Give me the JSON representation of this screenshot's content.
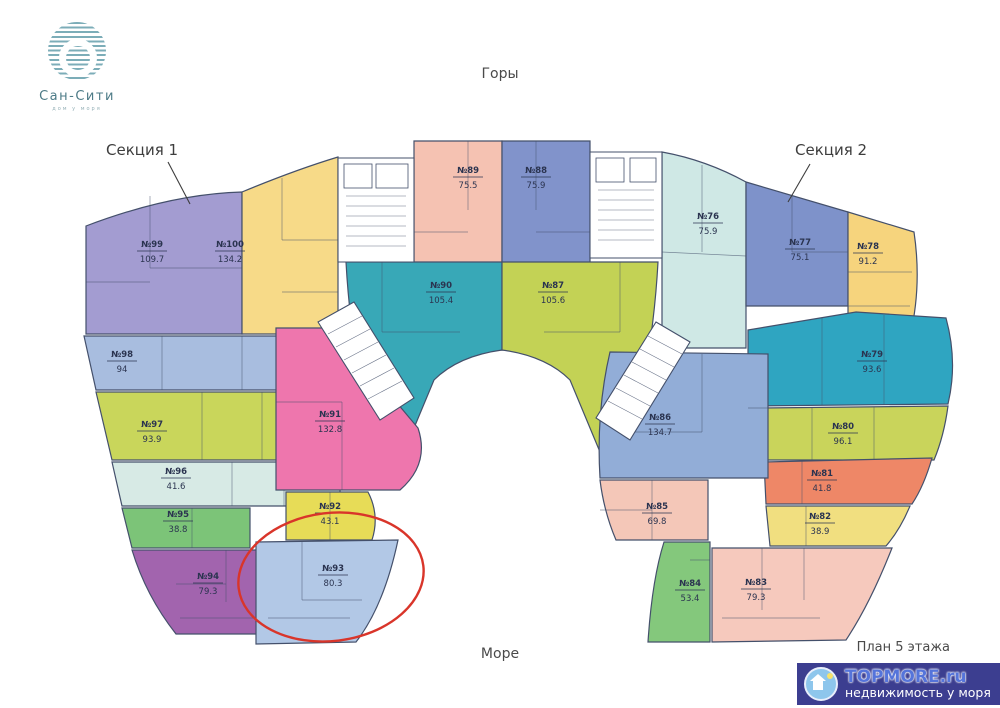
{
  "brand": {
    "name": "Сан-Сити",
    "tagline": "дом у моря",
    "logo_color": "#7cadb8"
  },
  "labels": {
    "top_direction": "Горы",
    "bottom_direction": "Море",
    "section1": "Секция 1",
    "section2": "Секция 2",
    "plan_caption": "План 5 этажа"
  },
  "watermark": {
    "title": "TOPMORE.ru",
    "subtitle": "недвижимость у моря",
    "bg": "#3c3e90"
  },
  "highlight": {
    "target": "№93",
    "color": "#d9352a",
    "cx": 331,
    "cy": 577,
    "rx": 93,
    "ry": 64,
    "rotate": -7
  },
  "plan": {
    "stroke": "#44506b",
    "leaders": [
      [
        168,
        162,
        190,
        204
      ],
      [
        810,
        164,
        788,
        202
      ]
    ],
    "apartments": [
      {
        "id": "99",
        "number": "№99",
        "area": "109.7",
        "color": "#a39cd1",
        "label": [
          152,
          250
        ],
        "path": "M86,226 Q170,194 242,192 L242,334 L86,334 Z",
        "partitions": [
          [
            150,
            196,
            150,
            268
          ],
          [
            150,
            268,
            242,
            268
          ],
          [
            86,
            282,
            150,
            282
          ]
        ]
      },
      {
        "id": "100",
        "number": "№100",
        "area": "134.2",
        "color": "#f7da88",
        "label": [
          230,
          250
        ],
        "path": "M242,192 Q295,170 338,157 L338,334 L242,334 Z",
        "partitions": [
          [
            282,
            178,
            282,
            240
          ],
          [
            282,
            240,
            338,
            240
          ],
          [
            282,
            292,
            338,
            292
          ]
        ]
      },
      {
        "id": "89",
        "number": "№89",
        "area": "75.5",
        "color": "#f5c2b2",
        "label": [
          468,
          176
        ],
        "path": "M414,141 L502,141 L502,350 L414,350 Z",
        "partitions": [
          [
            414,
            232,
            468,
            232
          ],
          [
            468,
            141,
            468,
            210
          ],
          [
            438,
            292,
            502,
            292
          ]
        ]
      },
      {
        "id": "88",
        "number": "№88",
        "area": "75.9",
        "color": "#8193cb",
        "label": [
          536,
          176
        ],
        "path": "M502,141 L590,141 L590,350 L502,350 Z",
        "partitions": [
          [
            536,
            141,
            536,
            210
          ],
          [
            536,
            232,
            590,
            232
          ],
          [
            502,
            292,
            566,
            292
          ]
        ]
      },
      {
        "id": "90",
        "number": "№90",
        "area": "105.4",
        "color": "#38a8b7",
        "label": [
          441,
          291
        ],
        "path": "M346,262 L502,262 L502,350 Q458,356 434,380 L404,452 L366,408 Q350,336 346,262 Z",
        "partitions": [
          [
            382,
            262,
            382,
            332
          ],
          [
            382,
            332,
            460,
            332
          ]
        ]
      },
      {
        "id": "87",
        "number": "№87",
        "area": "105.6",
        "color": "#c3d255",
        "label": [
          553,
          291
        ],
        "path": "M502,262 L658,262 Q654,336 638,408 L600,452 L570,380 Q546,356 502,350 Z",
        "partitions": [
          [
            620,
            262,
            620,
            332
          ],
          [
            544,
            332,
            620,
            332
          ]
        ]
      },
      {
        "id": "98",
        "number": "№98",
        "area": "94",
        "color": "#a8bddf",
        "label": [
          122,
          360
        ],
        "path": "M84,336 L336,336 L336,390 L96,390 Z",
        "partitions": [
          [
            162,
            336,
            162,
            390
          ],
          [
            242,
            336,
            242,
            390
          ],
          [
            284,
            336,
            284,
            390
          ]
        ]
      },
      {
        "id": "97",
        "number": "№97",
        "area": "93.9",
        "color": "#c9d65b",
        "label": [
          152,
          430
        ],
        "path": "M96,392 L336,392 L336,460 L112,460 Z",
        "partitions": [
          [
            202,
            392,
            202,
            460
          ],
          [
            262,
            392,
            262,
            460
          ]
        ]
      },
      {
        "id": "96",
        "number": "№96",
        "area": "41.6",
        "color": "#d7eae5",
        "label": [
          176,
          477
        ],
        "path": "M112,462 L340,462 L340,506 L122,506 Z",
        "partitions": [
          [
            232,
            462,
            232,
            506
          ],
          [
            284,
            462,
            284,
            506
          ]
        ]
      },
      {
        "id": "95",
        "number": "№95",
        "area": "38.8",
        "color": "#7cc478",
        "label": [
          178,
          520
        ],
        "path": "M122,508 L250,508 L250,548 L132,548 Z",
        "partitions": [
          [
            192,
            508,
            192,
            548
          ]
        ]
      },
      {
        "id": "94",
        "number": "№94",
        "area": "79.3",
        "color": "#a264ae",
        "label": [
          208,
          582
        ],
        "path": "M132,550 L272,550 L272,634 L176,634 Q146,596 132,550 Z",
        "partitions": [
          [
            226,
            550,
            226,
            602
          ],
          [
            176,
            584,
            226,
            584
          ],
          [
            180,
            618,
            268,
            618
          ]
        ]
      },
      {
        "id": "91",
        "number": "№91",
        "area": "132.8",
        "color": "#ee76ad",
        "label": [
          330,
          420
        ],
        "path": "M276,328 L334,328 L418,428 Q430,464 400,490 L276,490 Z",
        "partitions": [
          [
            276,
            402,
            342,
            402
          ],
          [
            342,
            402,
            342,
            490
          ]
        ]
      },
      {
        "id": "92",
        "number": "№92",
        "area": "43.1",
        "color": "#e7dc57",
        "label": [
          330,
          512
        ],
        "path": "M286,492 L368,492 Q380,515 372,540 L286,540 Z",
        "partitions": [
          [
            330,
            492,
            330,
            540
          ]
        ]
      },
      {
        "id": "93",
        "number": "№93",
        "area": "80.3",
        "color": "#b2c8e6",
        "label": [
          333,
          574
        ],
        "path": "M256,542 L398,540 Q384,606 356,642 L256,644 Z",
        "partitions": [
          [
            302,
            542,
            302,
            600
          ],
          [
            302,
            600,
            362,
            600
          ],
          [
            268,
            618,
            350,
            618
          ]
        ]
      },
      {
        "id": "76",
        "number": "№76",
        "area": "75.9",
        "color": "#cfe8e5",
        "label": [
          708,
          222
        ],
        "path": "M662,152 Q706,160 746,182 L746,348 L662,348 Z",
        "partitions": [
          [
            702,
            165,
            702,
            252
          ],
          [
            662,
            252,
            746,
            256
          ]
        ]
      },
      {
        "id": "77",
        "number": "№77",
        "area": "75.1",
        "color": "#7e92ca",
        "label": [
          800,
          248
        ],
        "path": "M746,182 L848,212 L848,306 L746,306 Z",
        "partitions": [
          [
            792,
            196,
            792,
            252
          ],
          [
            792,
            252,
            848,
            252
          ]
        ]
      },
      {
        "id": "78",
        "number": "№78",
        "area": "91.2",
        "color": "#f6d47d",
        "label": [
          868,
          252
        ],
        "path": "M848,212 L914,232 Q922,286 910,336 L848,336 Z",
        "partitions": [
          [
            848,
            272,
            912,
            272
          ],
          [
            848,
            306,
            910,
            306
          ]
        ]
      },
      {
        "id": "79",
        "number": "№79",
        "area": "93.6",
        "color": "#2fa5c1",
        "label": [
          872,
          360
        ],
        "path": "M748,330 L856,312 L946,318 Q958,362 948,404 L748,406 Z",
        "partitions": [
          [
            822,
            318,
            822,
            405
          ],
          [
            884,
            315,
            884,
            404
          ]
        ]
      },
      {
        "id": "80",
        "number": "№80",
        "area": "96.1",
        "color": "#c9d45b",
        "label": [
          843,
          432
        ],
        "path": "M762,408 L948,406 Q944,436 934,460 L764,460 Z",
        "partitions": [
          [
            812,
            407,
            812,
            460
          ],
          [
            874,
            407,
            874,
            460
          ]
        ]
      },
      {
        "id": "81",
        "number": "№81",
        "area": "41.8",
        "color": "#ee8767",
        "label": [
          822,
          479
        ],
        "path": "M764,462 L932,458 Q924,486 912,504 L766,504 Z",
        "partitions": [
          [
            802,
            460,
            802,
            504
          ]
        ]
      },
      {
        "id": "82",
        "number": "№82",
        "area": "38.9",
        "color": "#f1df80",
        "label": [
          820,
          522
        ],
        "path": "M766,506 L910,506 Q900,530 886,546 L770,546 Z",
        "partitions": [
          [
            806,
            506,
            806,
            546
          ]
        ]
      },
      {
        "id": "83",
        "number": "№83",
        "area": "79.3",
        "color": "#f6c9bd",
        "label": [
          756,
          588
        ],
        "path": "M712,548 L892,548 Q870,604 846,640 L712,642 Z",
        "partitions": [
          [
            762,
            548,
            762,
            610
          ],
          [
            804,
            548,
            804,
            600
          ],
          [
            722,
            618,
            820,
            618
          ]
        ]
      },
      {
        "id": "84",
        "number": "№84",
        "area": "53.4",
        "color": "#84c87c",
        "label": [
          690,
          589
        ],
        "path": "M664,542 L710,542 L710,642 L648,642 Q652,580 664,542 Z",
        "partitions": [
          [
            690,
            560,
            710,
            560
          ]
        ]
      },
      {
        "id": "85",
        "number": "№85",
        "area": "69.8",
        "color": "#f4c7b8",
        "label": [
          657,
          512
        ],
        "path": "M600,480 L708,480 L708,540 L616,540 Q604,512 600,480 Z",
        "partitions": [
          [
            652,
            480,
            652,
            540
          ],
          [
            600,
            510,
            652,
            510
          ]
        ]
      },
      {
        "id": "86",
        "number": "№86",
        "area": "134.7",
        "color": "#92add7",
        "label": [
          660,
          423
        ],
        "path": "M610,352 L768,354 L768,478 L600,478 Q596,412 610,352 Z",
        "partitions": [
          [
            702,
            354,
            702,
            432
          ],
          [
            620,
            432,
            702,
            432
          ],
          [
            748,
            408,
            768,
            408
          ]
        ]
      }
    ],
    "cores": [
      {
        "id": "stair-core-left",
        "path": "M338,158 L414,158 L414,262 L338,262 Z",
        "lines": [
          [
            346,
            196,
            406,
            196
          ],
          [
            346,
            206,
            406,
            206
          ],
          [
            346,
            216,
            406,
            216
          ],
          [
            346,
            226,
            406,
            226
          ],
          [
            346,
            236,
            406,
            236
          ],
          [
            346,
            246,
            406,
            246
          ]
        ],
        "shafts": [
          [
            344,
            164,
            28,
            24
          ],
          [
            376,
            164,
            32,
            24
          ]
        ]
      },
      {
        "id": "stair-core-right",
        "path": "M590,152 L662,152 L662,258 L590,258 Z",
        "lines": [
          [
            598,
            190,
            654,
            190
          ],
          [
            598,
            200,
            654,
            200
          ],
          [
            598,
            210,
            654,
            210
          ],
          [
            598,
            220,
            654,
            220
          ],
          [
            598,
            230,
            654,
            230
          ],
          [
            598,
            240,
            654,
            240
          ]
        ],
        "shafts": [
          [
            596,
            158,
            28,
            24
          ],
          [
            630,
            158,
            26,
            24
          ]
        ]
      },
      {
        "id": "stair-core-left-diagonal",
        "path": "M318,322 L354,302 L414,398 L380,420 Z",
        "lines": [
          [
            328,
            334,
            362,
            316
          ],
          [
            336,
            347,
            370,
            329
          ],
          [
            344,
            360,
            378,
            342
          ],
          [
            352,
            373,
            386,
            355
          ],
          [
            360,
            386,
            394,
            368
          ],
          [
            368,
            399,
            402,
            381
          ]
        ],
        "shafts": []
      },
      {
        "id": "stair-core-right-diagonal",
        "path": "M656,322 L690,342 L630,440 L596,418 Z",
        "lines": [
          [
            648,
            336,
            682,
            354
          ],
          [
            640,
            349,
            674,
            367
          ],
          [
            632,
            362,
            666,
            380
          ],
          [
            624,
            375,
            658,
            393
          ],
          [
            616,
            388,
            650,
            406
          ],
          [
            608,
            401,
            642,
            419
          ]
        ],
        "shafts": []
      }
    ]
  }
}
